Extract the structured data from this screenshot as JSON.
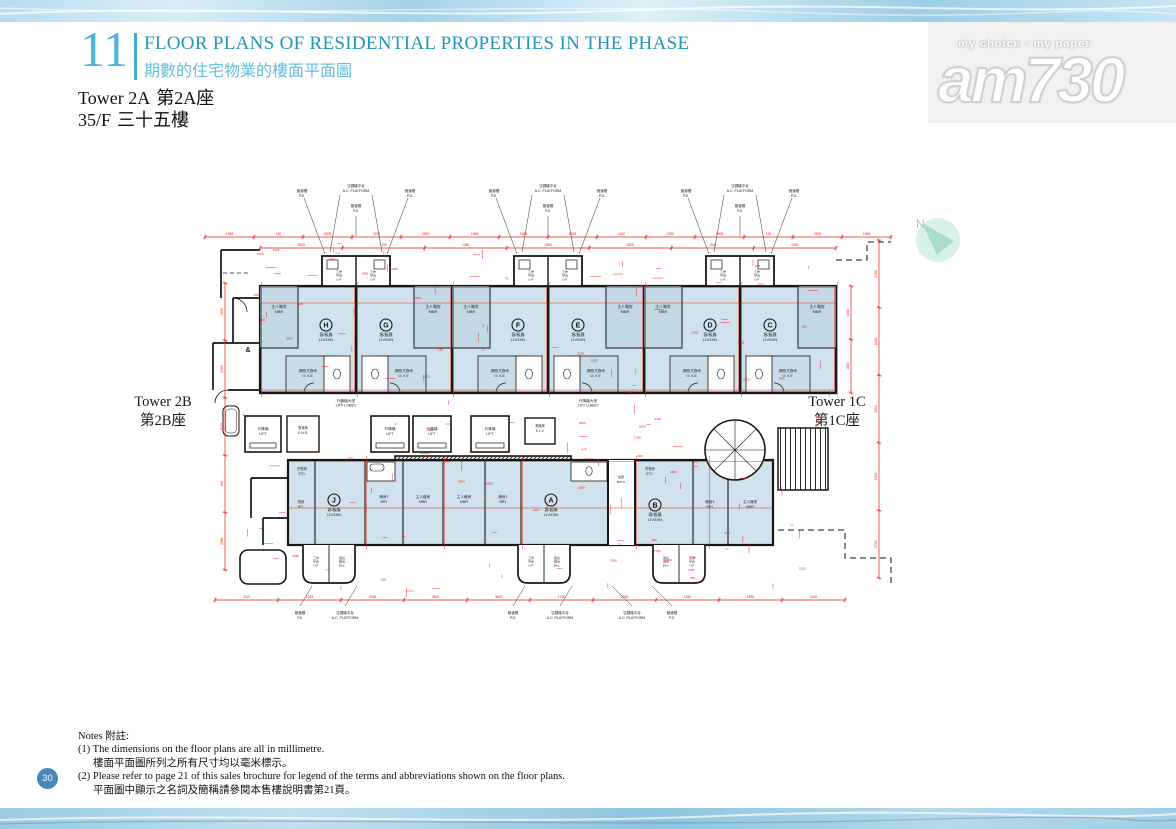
{
  "header": {
    "section_number": "11",
    "title_en": "FLOOR PLANS OF RESIDENTIAL PROPERTIES IN THE PHASE",
    "title_zh": "期數的住宅物業的樓面平面圖"
  },
  "subject": {
    "tower_en": "Tower 2A",
    "tower_zh": "第2A座",
    "floor_en": "35/F",
    "floor_zh": "三十五樓"
  },
  "watermark": {
    "tagline": "my choice · my paper",
    "logo": "am730"
  },
  "neighbors": {
    "left_en": "Tower 2B",
    "left_zh": "第2B座",
    "right_en": "Tower 1C",
    "right_zh": "第1C座"
  },
  "compass": {
    "label": "N"
  },
  "footer": {
    "page_number": "30"
  },
  "notes": {
    "heading": "Notes 附註:",
    "line1_en": "(1) The dimensions on the floor plans are all in millimetre.",
    "line1_zh": "樓面平面圖所列之所有尺寸均以毫米標示。",
    "line2_en": "(2) Please refer to page 21 of this sales brochure for legend of the terms and abbreviations shown on the floor plans.",
    "line2_zh": "平面圖中顯示之名詞及簡稱請參閱本售樓說明書第21頁。"
  },
  "plan": {
    "top_units": [
      "H",
      "G",
      "F",
      "E",
      "D",
      "C"
    ],
    "bottom_units": [
      "J",
      "A",
      "B"
    ],
    "labels": {
      "mbr": [
        "主人睡房",
        "MBR"
      ],
      "livdin": [
        "客/飯廳",
        "LIV/DIN"
      ],
      "okit": [
        "開放式廚房",
        "O. KIT."
      ],
      "kit": [
        "廚房",
        "KIT."
      ],
      "br1": [
        "睡房1",
        "BR1"
      ],
      "sto": [
        "貯物房",
        "STO."
      ],
      "bath": [
        "浴室",
        "BATH"
      ],
      "lift": [
        "升降機",
        "LIFT"
      ],
      "lobby": [
        "升降機大堂",
        "LIFT LOBBY"
      ],
      "emr": [
        "電梯房",
        "E.M.R."
      ],
      "elv": [
        "電錶房",
        "E.L.V."
      ],
      "up": [
        "工作平台",
        "U.P."
      ],
      "bal": [
        "露台",
        "BAL."
      ],
      "pd": [
        "管道槽",
        "P.D."
      ],
      "acp": [
        "空調機平台",
        "A.C. PLATFORM"
      ]
    },
    "dims_top": [
      "1968",
      "150",
      "2825",
      "1150",
      "2360",
      "1968",
      "1584",
      "2825",
      "1150",
      "2360",
      "1968",
      "150",
      "2825",
      "1968"
    ],
    "dims_top2": [
      "2825",
      "1150",
      "2360",
      "1584",
      "2825",
      "1150",
      "2360"
    ],
    "dims_bottom": [
      "1110",
      "1933",
      "2938",
      "4500",
      "3600",
      "1780",
      "2938",
      "1350",
      "1690",
      "4150"
    ],
    "dims_left": [
      "2300",
      "3450",
      "5325",
      "150",
      "2050"
    ],
    "dims_right": [
      "2100",
      "5325",
      "3393",
      "1500",
      "2728"
    ],
    "dims_right2": [
      "2100",
      "1500"
    ],
    "dims_scatter": [
      "2825",
      "1150",
      "75",
      "150",
      "2360",
      "3400",
      "2050",
      "1325",
      "2110",
      "650",
      "3000",
      "1550",
      "200",
      "2300",
      "1780",
      "900",
      "3350",
      "1100",
      "2335",
      "475"
    ]
  }
}
